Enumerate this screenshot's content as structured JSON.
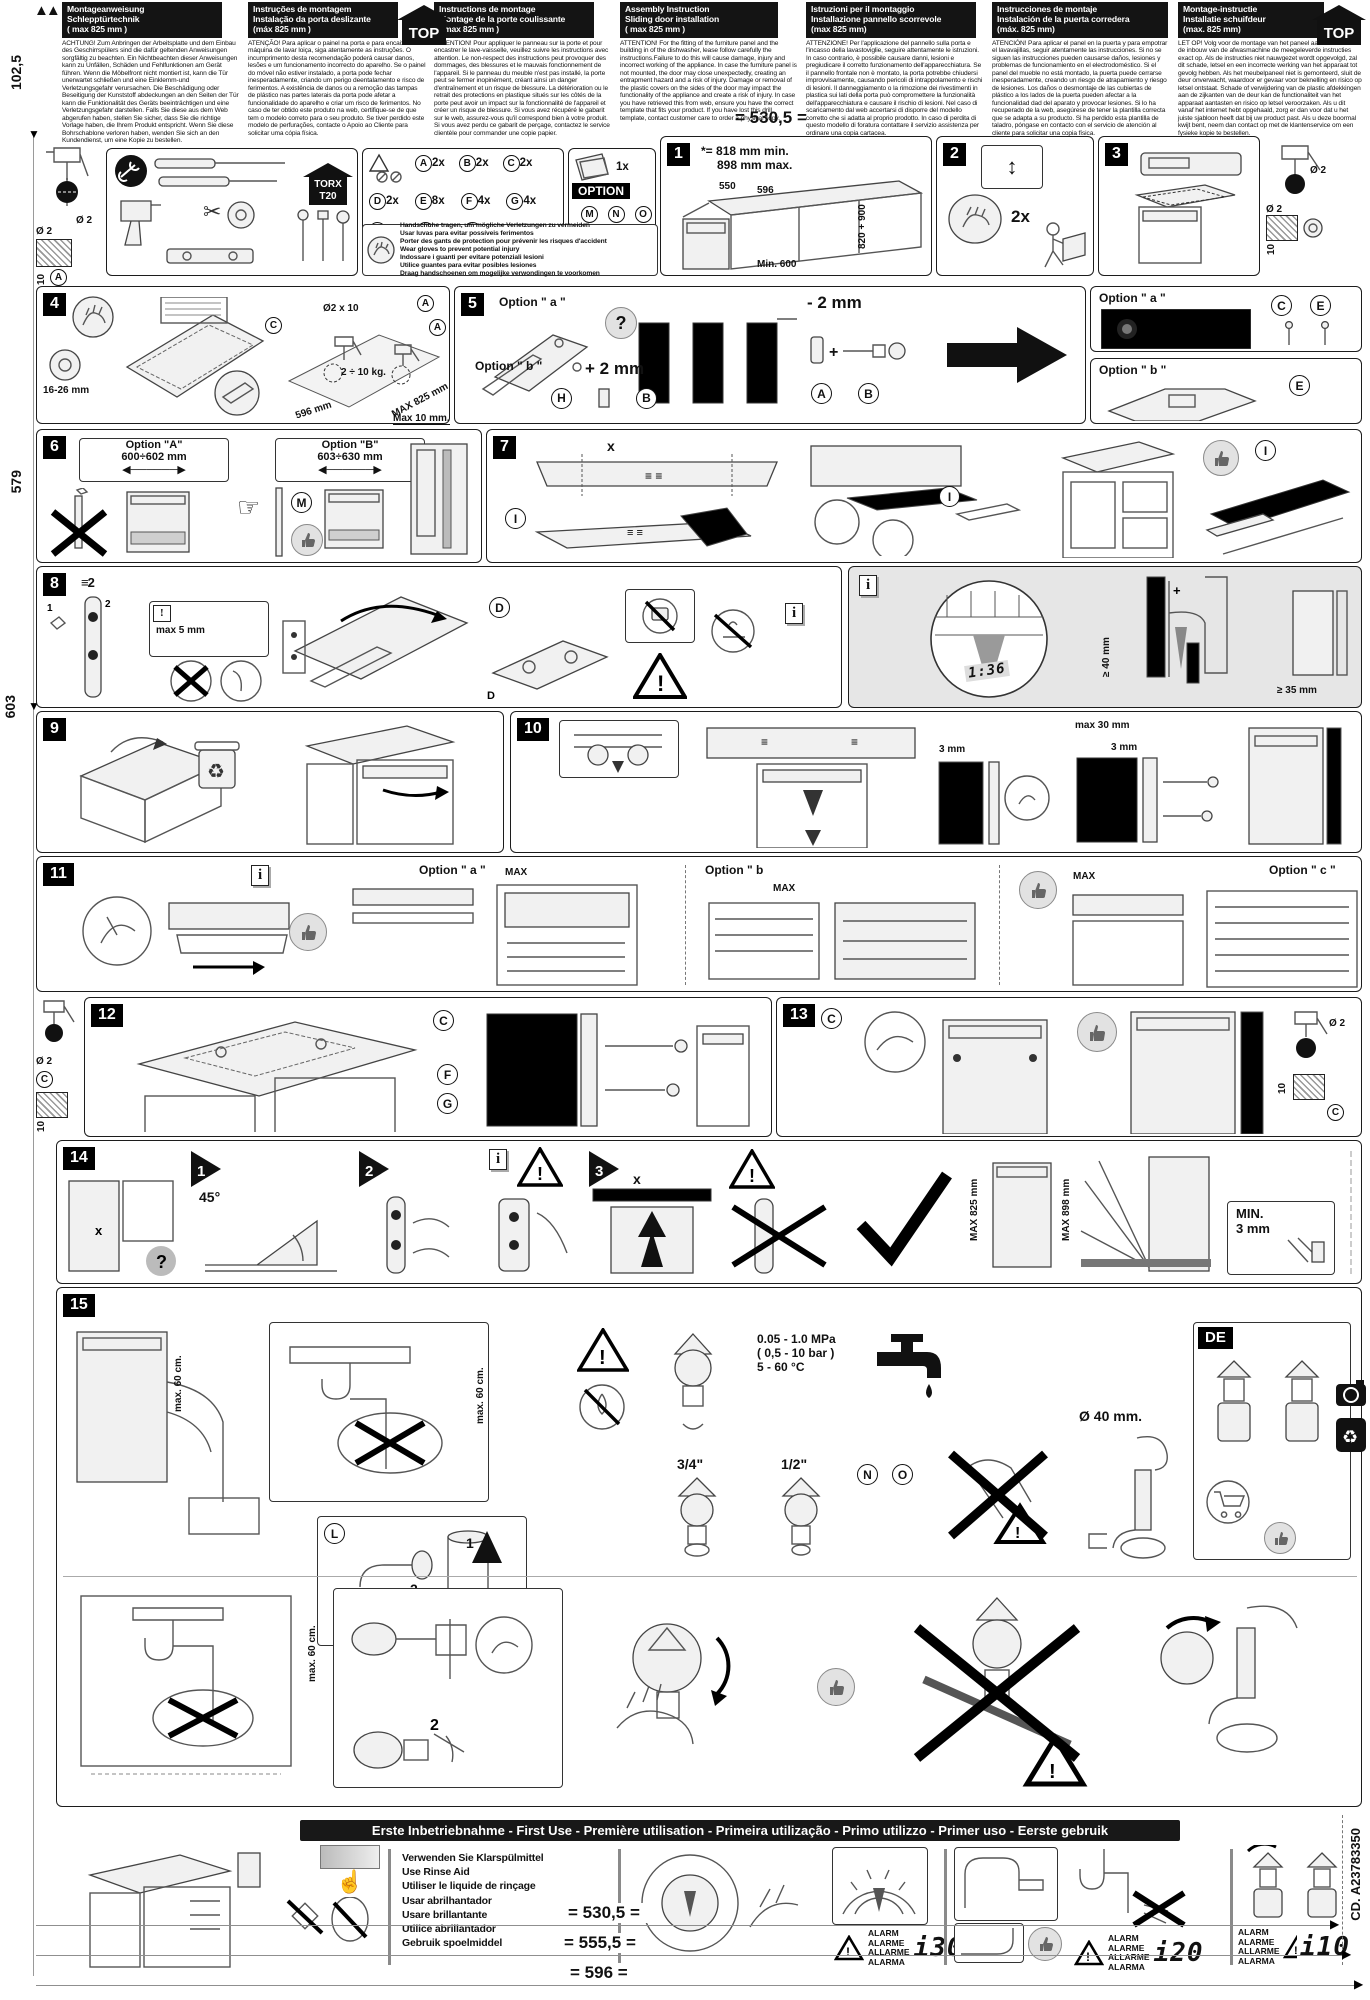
{
  "dims": {
    "eq": "=",
    "top": "530,5",
    "left_top": "102,5",
    "left_mid": "579",
    "left_low": "603",
    "bottom": [
      "530,5",
      "555,5",
      "596"
    ],
    "phi2": "Ø 2",
    "d10": "10"
  },
  "page": {
    "code": "CD. A23783350"
  },
  "header": {
    "top": "TOP",
    "cols": [
      {
        "t": [
          "Montageanweisung",
          "Schlepptürtechnik",
          "( max 825 mm )"
        ],
        "body": "ACHTUNG! Zum Anbringen der Arbeitsplatte und dem Einbau des Geschirrspülers sind die dafür geltenden Anweisungen sorgfältig zu beachten. Ein Nichtbeachten dieser Anweisungen kann zu Unfällen, Schäden und Fehlfunktionen am Gerät führen. Wenn die Möbelfront nicht montiert ist, kann die Tür unerwartet schließen und eine Einklemm-und Verletzungsgefahr verursachen. Die Beschädigung oder Beseitigung der Kunststoff abdeckungen an den Seiten der Tür kann die Funktionalität des Geräts beeinträchtigen und eine Verletzungsgefahr darstellen. Falls Sie diese aus dem Web abgerufen haben, stellen Sie sicher, dass Sie die richtige Vorlage haben, die Ihrem Produkt entspricht. Wenn Sie diese Bohrschablone verloren haben, wenden Sie sich an den Kundendienst, um eine Kopie zu bestellen."
      },
      {
        "t": [
          "Instruções de montagem",
          "Instalação da porta deslizante",
          "(máx 825 mm )"
        ],
        "body": "ATENÇÃO! Para aplicar o painel na porta e para encaixar a máquina de lavar loiça, siga atentamente as instruções. O incumprimento desta recomendação poderá causar danos, lesões e um funcionamento incorrecto do aparelho. Se o painel do móvel não estiver instalado, a porta pode fechar inesperadamente, criando um perigo deentalamento e risco de ferimentos. A existência de danos ou a remoção das tampas de plástico nas partes laterais da porta pode afetar a funcionalidade do aparelho e criar um risco de ferimentos. No caso de ter obtido este produto na web, certifique-se de que tem o modelo correto para o seu produto. Se tiver perdido este modelo de perfurações, contacte o Apoio ao Cliente para solicitar uma cópia física."
      },
      {
        "t": [
          "Instructions de montage",
          "Montage de la porte coulissante",
          "( max 825 mm )"
        ],
        "body": "ATTENTION! Pour appliquer le panneau sur la porte et pour encastrer le lave-vaisselle, veuillez suivre les instructions avec attention. Le non-respect des instructions peut provoquer des dommages, des blessures et le mauvais fonctionnement de l'appareil. Si le panneau du meuble n'est pas installé, la porte peut se fermer inopinément, créant ainsi un danger d'entraînement et un risque de blessure. La détérioration ou le retrait des protections en plastique situés sur les côtés de la porte peut avoir un impact sur la fonctionnalité de l'appareil et créer un risque de blessure. Si vous avez récupéré le gabarit sur le web, assurez-vous qu'il correspond bien à votre produit. Si vous avez perdu ce gabarit de perçage, contactez le service clientèle pour commander une copie papier."
      },
      {
        "t": [
          "Assembly Instruction",
          "Sliding door installation",
          "( max 825 mm )"
        ],
        "body": "ATTENTION! For the fitting of the furniture panel and the building in of the dishwasher, lease follow carefully the instructions.Failure to do this will cause damage, injury and incorrect working of the appliance. In case the furniture panel is not mounted, the door may close unexpectedly, creating an entrapment hazard and a risk of injury. Damage or removal of the plastic covers on the sides of the door may impact the functionality of the appliance and create a risk of injury. In case you have retrieved this from web, ensure you have the correct template that fits your product. If you have lost this drill template, contact customer care to order a physical copy."
      },
      {
        "t": [
          "Istruzioni per il montaggio",
          "Installazione pannello scorrevole",
          "(max 825 mm)"
        ],
        "body": "ATTENZIONE! Per l'applicazione del pannello sulla porta e l'incasso della lavastoviglie, seguire attentamente le istruzioni. In caso contrario, è possibile causare danni, lesioni e pregiudicare il corretto funzionamento dell'apparecchiatura. Se il pannello frontale non è montato, la porta potrebbe chiudersi improvvisamente, causando pericoli di intrappolamento e rischi di lesioni. Il danneggiamento o la rimozione dei rivestimenti in plastica sui lati della porta può compromettere la funzionalità dell'apparecchiatura e causare il rischio di lesioni. Nel caso di scaricamento dal web accertarsi di disporre del modello corretto che si adatta al proprio prodotto. In caso di perdita di questo modello di foratura contattare il servizio assistenza per ordinare una copia cartacea."
      },
      {
        "t": [
          "Instrucciones de montaje",
          "Instalación de la puerta corredera",
          "(máx. 825 mm)"
        ],
        "body": "ATENCIÓN! Para aplicar el panel en la puerta y para empotrar el lavavajillas, seguir atentamente las instrucciones. Si no se siguen las instrucciones pueden causarse daños, lesiones y problemas de funcionamiento en el electrodoméstico. Si el panel del mueble no está montado, la puerta puede cerrarse inesperadamente, creando un riesgo de atrapamiento y riesgo de lesiones. Los daños o desmontaje de las cubiertas de plástico a los lados de la puerta pueden afectar a la funcionalidad dad del aparato y provocar lesiones. Si lo ha recuperado de la web, asegúrese de tener la plantilla correcta que se adapta a su producto. Si ha perdido esta plantilla de taladro, póngase en contacto con el servicio de atención al cliente para solicitar una copia física."
      },
      {
        "t": [
          "Montage-instructie",
          "Installatie schuifdeur",
          "(max. 825 mm)"
        ],
        "body": "LET OP! Volg voor de montage van het paneel aan de deur en de inbouw van de afwasmachine de meegeleverde instructies exact op. Als de instructies niet nauwgezet wordt opgevolgd, zal dit schade, letsel en een incorrecte werking van het apparaat tot gevolg hebben. Als het meubelpaneel niet is gemonteerd, sluit de deur onverwacht, waardoor er gevaar voor beknelling en risico op letsel ontstaat. Schade of verwijdering van de plastic afdekkingen aan de zijkanten van de deur kan de functionaliteit van het apparaat aantasten en risico op letsel veroorzaken. Als u dit vanaf het internet hebt opgehaald, zorg er dan voor dat u het juiste sjabloon heeft dat bij uw product past. Als u deze boormal kwijt bent, neem dan contact op met de klantenservice om een fysieke kopie te bestellen."
      }
    ]
  },
  "tools": {
    "torx1": "TORX",
    "torx2": "T20",
    "option": "OPTION",
    "booklet_qty": "1x"
  },
  "parts": {
    "a": "A",
    "b": "B",
    "c": "C",
    "d": "D",
    "e": "E",
    "f": "F",
    "g": "G",
    "h": "H",
    "i": "I",
    "l": "L",
    "m": "M",
    "n": "N",
    "o": "O",
    "qa": "2x",
    "qb": "2x",
    "qc": "2x",
    "qd": "2x",
    "qe": "8x",
    "qf": "4x",
    "qg": "4x",
    "qh": "2x",
    "qi": "1x",
    "ql": "1x",
    "qm": "2x",
    "gloves": [
      "Handschuhe tragen, um mögliche Verletzungen zu vermeiden",
      "Usar luvas para evitar possíveis ferimentos",
      "Porter des gants de protection pour prévenir les risques d'accident",
      "Wear gloves to prevent potential injury",
      "Indossare i guanti per evitare potenziali lesioni",
      "Utilice guantes para evitar posibles lesiones",
      "Draag handschoenen om mogelijke verwondingen te voorkomen"
    ]
  },
  "steps": {
    "s1": {
      "n": "1",
      "star": "*=",
      "l1": "818 mm min.",
      "l2": "898 mm max.",
      "d550": "550",
      "d596": "596",
      "dvert": "820 + 900",
      "dmin": "Min. 600"
    },
    "s2": {
      "n": "2",
      "qty": "2x"
    },
    "s3": {
      "n": "3"
    },
    "s4": {
      "n": "4",
      "d1": "16-26 mm",
      "d2": "Ø2 x 10",
      "d3": "2 ÷ 10 kg.",
      "d4": "596 mm",
      "d5": "MAX 825 mm",
      "d6": "Max 10 mm."
    },
    "s5": {
      "n": "5",
      "oa": "Option \" a \"",
      "ob": "Option \" b \"",
      "m2": "- 2 mm",
      "p2": "+ 2 mm"
    },
    "s6": {
      "n": "6",
      "oa": "Option \"A\"",
      "ra": "600÷602 mm",
      "ob": "Option \"B\"",
      "rb": "603÷630 mm"
    },
    "s7": {
      "n": "7",
      "x": "x"
    },
    "s8": {
      "n": "8",
      "pre": "2",
      "max5": "max 5 mm",
      "scale": "1:36",
      "g40": "≥ 40 mm",
      "g35": "≥ 35 mm"
    },
    "s9": {
      "n": "9"
    },
    "s10": {
      "n": "10",
      "d1": "3 mm",
      "d2": "max 30 mm",
      "d3": "3 mm"
    },
    "s11": {
      "n": "11",
      "oa": "Option \" a \"",
      "ob": "Option \" b",
      "oc": "Option \" c \"",
      "max": "MAX"
    },
    "s12": {
      "n": "12"
    },
    "s13": {
      "n": "13"
    },
    "s14": {
      "n": "14",
      "k1": "1",
      "deg": "45°",
      "k2": "2",
      "k3": "3",
      "m825": "MAX 825 mm",
      "m898": "MAX 898 mm",
      "min3a": "MIN.",
      "min3b": "3 mm",
      "x": "x"
    },
    "s15": {
      "n": "15",
      "k1": "1",
      "k2": "2",
      "max60": "max. 60 cm.",
      "p1": "0.05 - 1.0 MPa",
      "p2": "( 0,5 - 10 bar )",
      "p3": "5 - 60 °C",
      "t34": "3/4\"",
      "t12": "1/2\"",
      "phi40": "Ø 40 mm.",
      "de": "DE"
    }
  },
  "firstuse": {
    "bar": "Erste Inbetriebnahme - First Use - Première utilisation - Primeira utilização - Primo utilizzo - Primer uso - Eerste gebruik",
    "rinse": [
      "Verwenden Sie Klarspülmittel",
      "Use Rinse Aid",
      "Utiliser le liquide de rinçage",
      "Usar abrilhantador",
      "Usare brillantante",
      "Utilice abrillantador",
      "Gebruik spoelmiddel"
    ],
    "alarm": [
      "ALARM",
      "ALARME",
      "ALLARME",
      "ALARMA"
    ],
    "codes": [
      "i30",
      "i20",
      "i10"
    ]
  }
}
